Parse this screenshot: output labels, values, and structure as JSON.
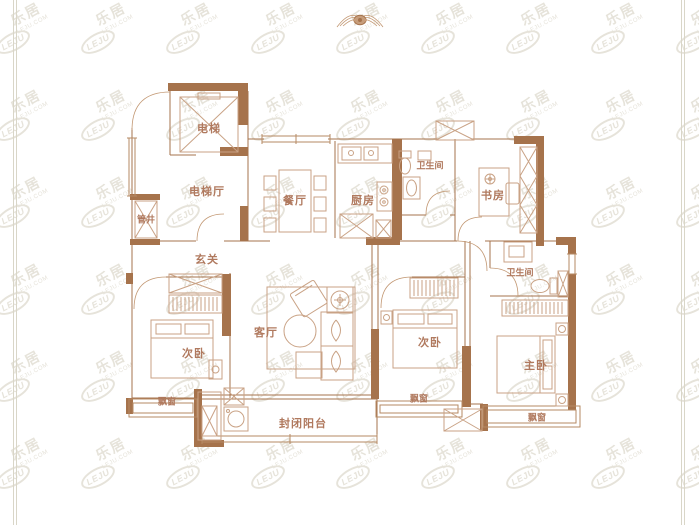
{
  "plan": {
    "type": "apartment-floor-plan",
    "rooms": {
      "elevator": "电梯",
      "elevator_hall": "电梯厅",
      "pipe_shaft": "管井",
      "dining": "餐厅",
      "kitchen": "厨房",
      "bathroom_top": "卫生间",
      "study": "书房",
      "entry": "玄关",
      "living": "客厅",
      "bedroom_left": "次卧",
      "bedroom_middle": "次卧",
      "bathroom_right": "卫生间",
      "master_bedroom": "主卧",
      "bay_window_left": "飘窗",
      "bay_window_middle": "飘窗",
      "bay_window_right": "飘窗",
      "balcony": "封闭阳台"
    },
    "colors": {
      "wall": "#a6734c",
      "furniture_line": "#c9a285",
      "window_line": "#b58a63",
      "label_text": "#b0795e",
      "watermark": "#e6e3da",
      "frame_line": "#d9d6c8",
      "background": "#ffffff"
    }
  },
  "watermark": {
    "logo": "LEJU",
    "name": "乐居",
    "domain": "LEJU.COM"
  }
}
